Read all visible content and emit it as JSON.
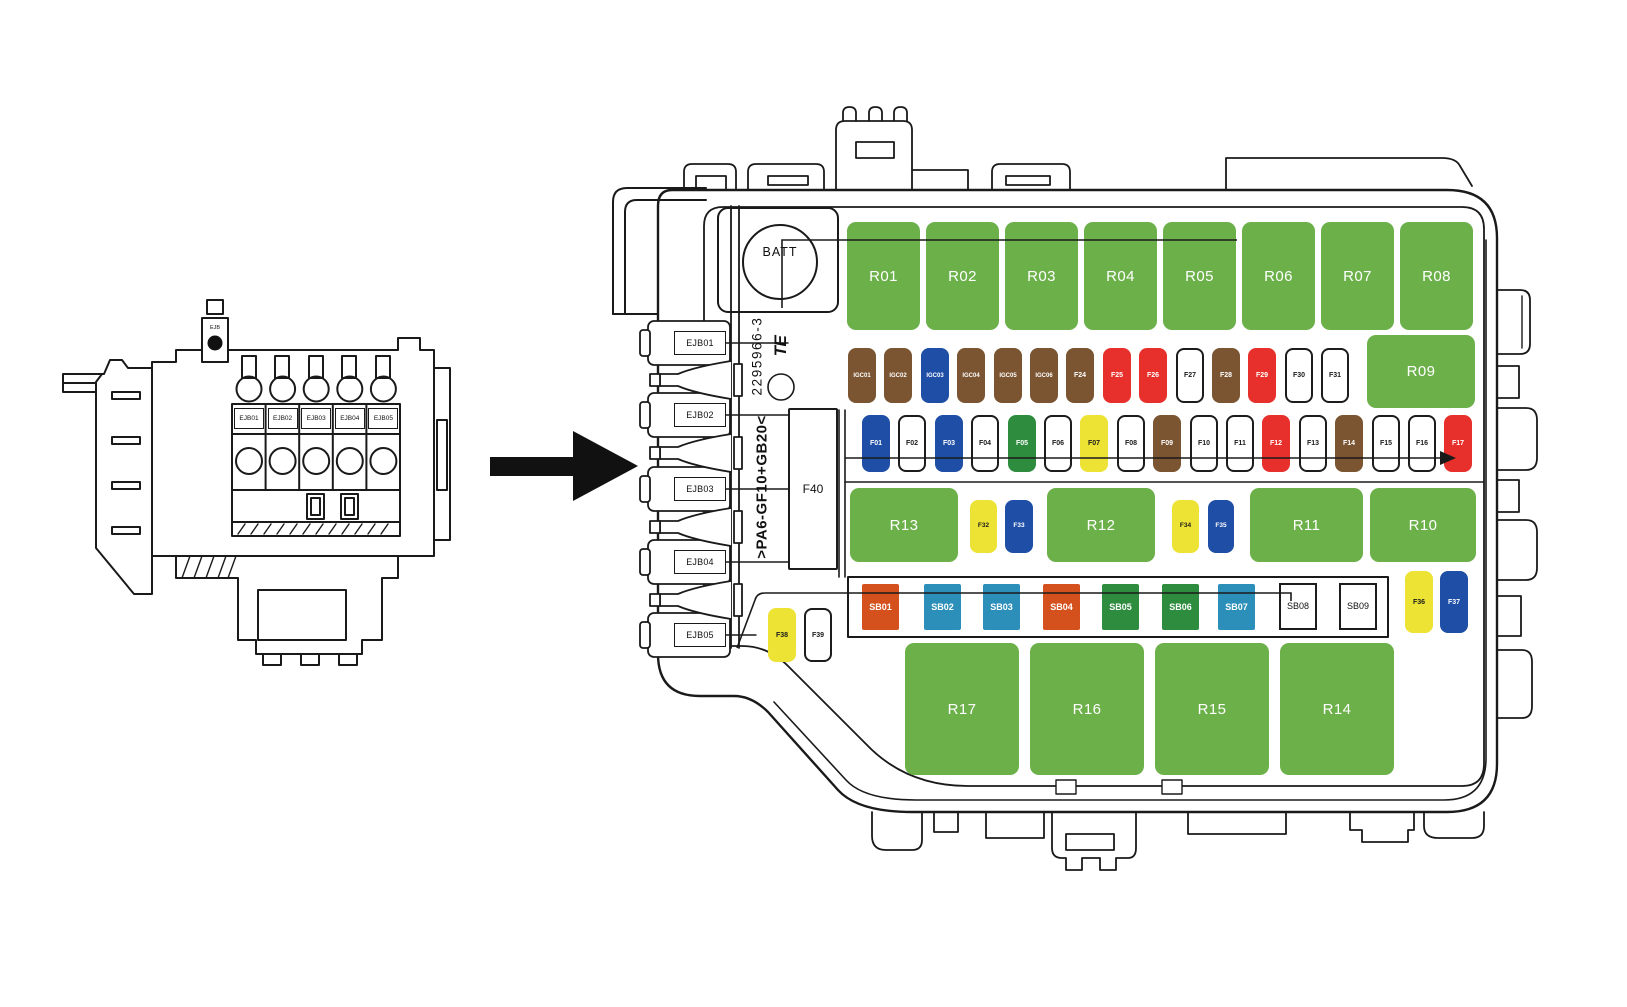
{
  "palette": {
    "green": "#6CB04A",
    "dark_green": "#2E8C3E",
    "brown": "#7B5431",
    "blue": "#1F4EA6",
    "red": "#E7302C",
    "yellow": "#EDE335",
    "orange": "#D4511E",
    "teal": "#2C8FB9",
    "white": "#FFFFFF",
    "line": "#1A1A1A"
  },
  "left_diagram": {
    "part_label": "EJB",
    "slot_labels": [
      "EJB01",
      "EJB02",
      "EJB03",
      "EJB04",
      "EJB05"
    ]
  },
  "fusebox": {
    "battery_label": "BATT",
    "part_number": "2295966-3",
    "material_code": ">PA6-GF10+GB20<",
    "logo_text": "TE",
    "connector_labels": [
      "EJB01",
      "EJB02",
      "EJB03",
      "EJB04",
      "EJB05"
    ],
    "elements": [
      {
        "id": "R01",
        "color": "green"
      },
      {
        "id": "R02",
        "color": "green"
      },
      {
        "id": "R03",
        "color": "green"
      },
      {
        "id": "R04",
        "color": "green"
      },
      {
        "id": "R05",
        "color": "green"
      },
      {
        "id": "R06",
        "color": "green"
      },
      {
        "id": "R07",
        "color": "green"
      },
      {
        "id": "R08",
        "color": "green"
      },
      {
        "id": "R09",
        "color": "green"
      },
      {
        "id": "IGC01",
        "color": "brown"
      },
      {
        "id": "IGC02",
        "color": "brown"
      },
      {
        "id": "IGC03",
        "color": "blue"
      },
      {
        "id": "IGC04",
        "color": "brown"
      },
      {
        "id": "IGC05",
        "color": "brown"
      },
      {
        "id": "IGC06",
        "color": "brown"
      },
      {
        "id": "F24",
        "color": "brown"
      },
      {
        "id": "F25",
        "color": "red"
      },
      {
        "id": "F26",
        "color": "red"
      },
      {
        "id": "F27",
        "color": "white"
      },
      {
        "id": "F28",
        "color": "brown"
      },
      {
        "id": "F29",
        "color": "red"
      },
      {
        "id": "F30",
        "color": "white"
      },
      {
        "id": "F31",
        "color": "white"
      },
      {
        "id": "F01",
        "color": "blue"
      },
      {
        "id": "F02",
        "color": "white"
      },
      {
        "id": "F03",
        "color": "blue"
      },
      {
        "id": "F04",
        "color": "white"
      },
      {
        "id": "F05",
        "color": "dark_green"
      },
      {
        "id": "F06",
        "color": "white"
      },
      {
        "id": "F07",
        "color": "yellow"
      },
      {
        "id": "F08",
        "color": "white"
      },
      {
        "id": "F09",
        "color": "brown"
      },
      {
        "id": "F10",
        "color": "white"
      },
      {
        "id": "F11",
        "color": "white"
      },
      {
        "id": "F12",
        "color": "red"
      },
      {
        "id": "F13",
        "color": "white"
      },
      {
        "id": "F14",
        "color": "brown"
      },
      {
        "id": "F15",
        "color": "white"
      },
      {
        "id": "F16",
        "color": "white"
      },
      {
        "id": "F17",
        "color": "red"
      },
      {
        "id": "R13",
        "color": "green"
      },
      {
        "id": "F32",
        "color": "yellow"
      },
      {
        "id": "F33",
        "color": "blue"
      },
      {
        "id": "R12",
        "color": "green"
      },
      {
        "id": "F34",
        "color": "yellow"
      },
      {
        "id": "F35",
        "color": "blue"
      },
      {
        "id": "R11",
        "color": "green"
      },
      {
        "id": "R10",
        "color": "green"
      },
      {
        "id": "SB01",
        "color": "orange"
      },
      {
        "id": "SB02",
        "color": "teal"
      },
      {
        "id": "SB03",
        "color": "teal"
      },
      {
        "id": "SB04",
        "color": "orange"
      },
      {
        "id": "SB05",
        "color": "dark_green"
      },
      {
        "id": "SB06",
        "color": "dark_green"
      },
      {
        "id": "SB07",
        "color": "teal"
      },
      {
        "id": "SB08",
        "color": "white_box"
      },
      {
        "id": "SB09",
        "color": "white_box"
      },
      {
        "id": "F36",
        "color": "yellow"
      },
      {
        "id": "F37",
        "color": "blue"
      },
      {
        "id": "F38",
        "color": "yellow"
      },
      {
        "id": "F39",
        "color": "white"
      },
      {
        "id": "F40",
        "color": "big_white"
      },
      {
        "id": "R17",
        "color": "green"
      },
      {
        "id": "R16",
        "color": "green"
      },
      {
        "id": "R15",
        "color": "green"
      },
      {
        "id": "R14",
        "color": "green"
      }
    ]
  }
}
